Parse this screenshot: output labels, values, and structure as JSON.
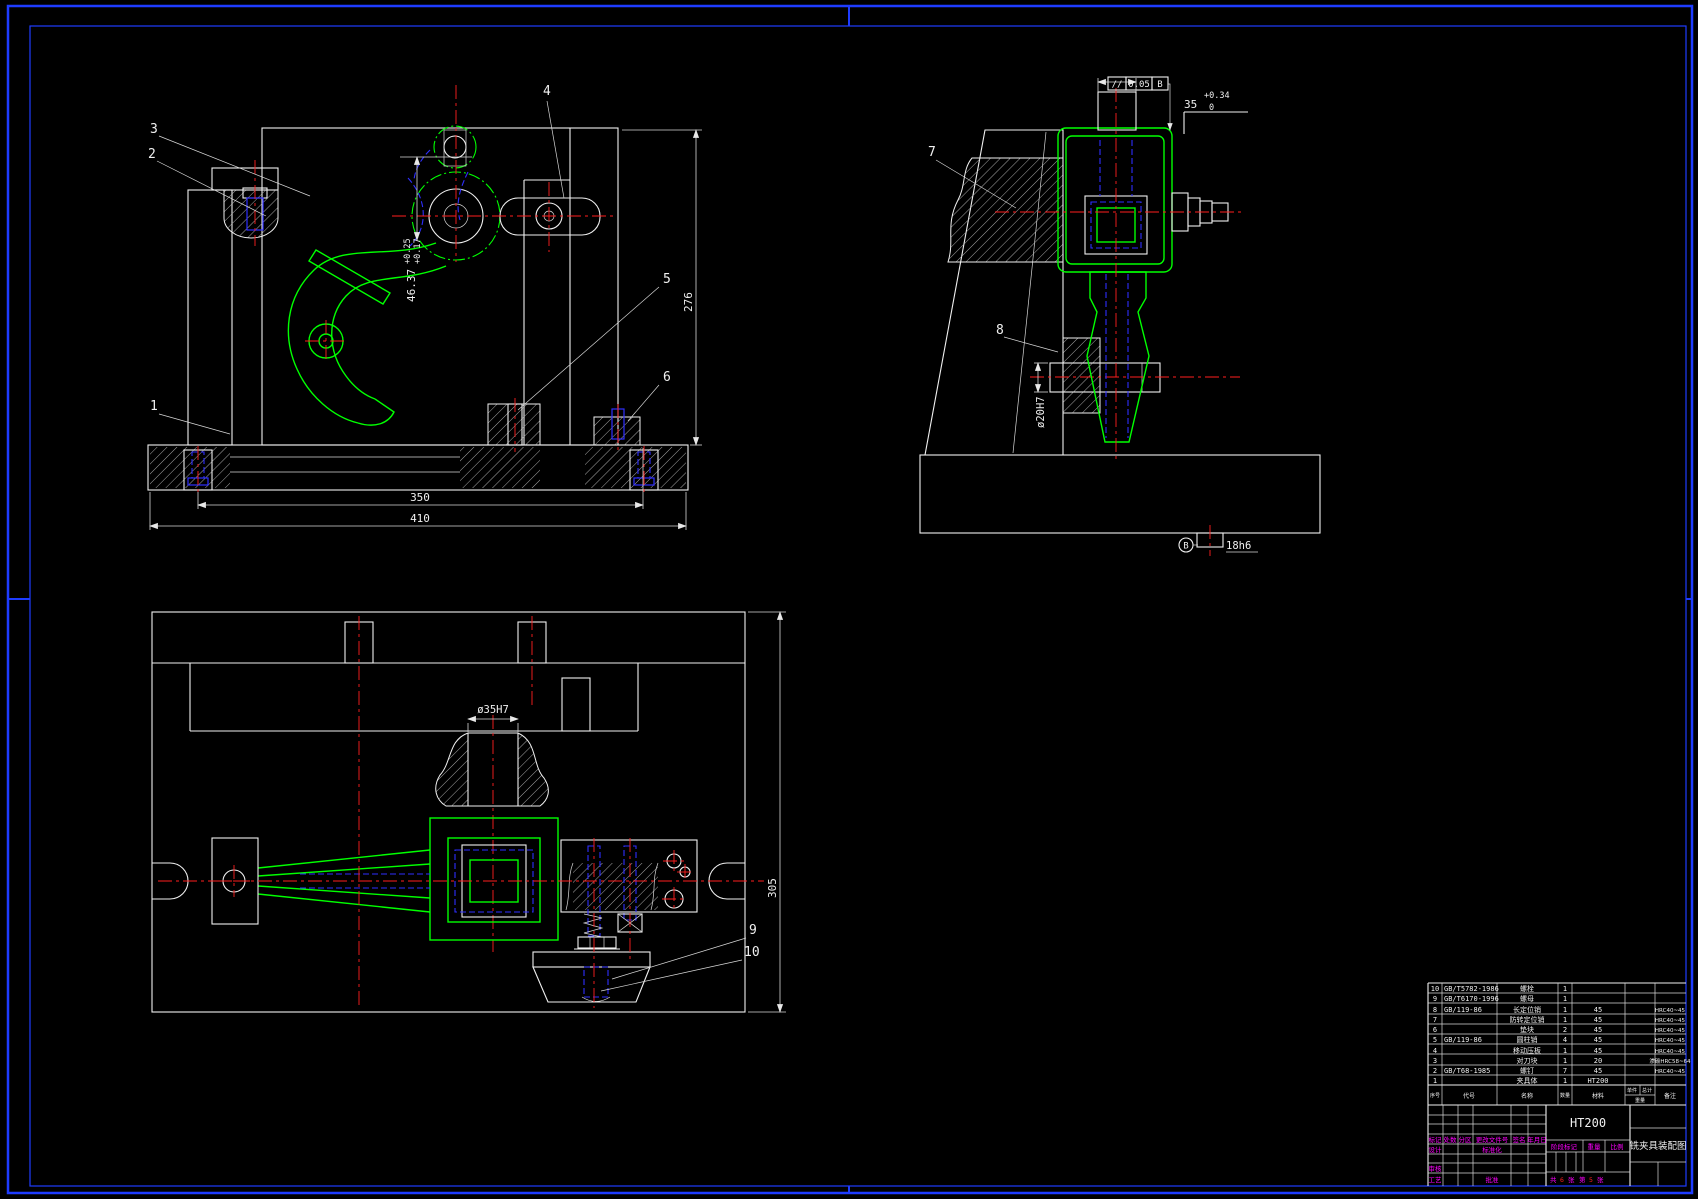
{
  "colors": {
    "frame_blue": "#1E3CFF",
    "line_white": "#F0F0F0",
    "part_green": "#00FF00",
    "center_red": "#FF1E1E",
    "hidden_blue": "#2E2EFF",
    "label_magenta": "#FF00FF"
  },
  "front_view": {
    "balloons": {
      "b1": "1",
      "b2": "2",
      "b3": "3",
      "b4": "4",
      "b5": "5",
      "b6": "6"
    },
    "dims": {
      "bore": "46.37",
      "bore_up": "+0.25",
      "bore_lo": "+0.17",
      "height": "276",
      "width_inner": "350",
      "width_outer": "410"
    }
  },
  "side_view": {
    "balloons": {
      "b7": "7",
      "b8": "8"
    },
    "dims": {
      "slot": "35",
      "slot_up": "+0.34",
      "slot_lo": "0",
      "pin": "ø20H7",
      "key": "18h6",
      "datum": "B"
    },
    "gdt": {
      "sym": "//",
      "val": "0.05",
      "ref": "B"
    }
  },
  "plan_view": {
    "balloons": {
      "b9": "9",
      "b10": "10"
    },
    "dims": {
      "hole": "ø35H7",
      "depth": "305"
    }
  },
  "parts_list": {
    "headers": {
      "no": "序号",
      "code": "代号",
      "name": "名称",
      "qty": "数量",
      "material": "材料",
      "wt_unit": "单件",
      "wt_total": "总计",
      "weight": "重量",
      "remark": "备注"
    },
    "rows": [
      {
        "no": "10",
        "code": "GB/T5782-1986",
        "name": "螺栓",
        "qty": "1",
        "material": "",
        "remark": ""
      },
      {
        "no": "9",
        "code": "GB/T6170-1996",
        "name": "螺母",
        "qty": "1",
        "material": "",
        "remark": ""
      },
      {
        "no": "8",
        "code": "GB/119-86",
        "name": "长定位销",
        "qty": "1",
        "material": "45",
        "remark": "HRC40~45"
      },
      {
        "no": "7",
        "code": "",
        "name": "防转定位销",
        "qty": "1",
        "material": "45",
        "remark": "HRC40~45"
      },
      {
        "no": "6",
        "code": "",
        "name": "垫块",
        "qty": "2",
        "material": "45",
        "remark": "HRC40~45"
      },
      {
        "no": "5",
        "code": "GB/119-86",
        "name": "圆柱销",
        "qty": "4",
        "material": "45",
        "remark": "HRC40~45"
      },
      {
        "no": "4",
        "code": "",
        "name": "移动压板",
        "qty": "1",
        "material": "45",
        "remark": "HRC40~45"
      },
      {
        "no": "3",
        "code": "",
        "name": "对刀块",
        "qty": "1",
        "material": "20",
        "remark": "渗碳HRC58~64"
      },
      {
        "no": "2",
        "code": "GB/T68-1985",
        "name": "螺钉",
        "qty": "7",
        "material": "45",
        "remark": "HRC40~45"
      },
      {
        "no": "1",
        "code": "",
        "name": "夹具体",
        "qty": "1",
        "material": "HT200",
        "remark": ""
      }
    ]
  },
  "title_block": {
    "material": "HT200",
    "drawing_title": "铣夹具装配图",
    "labels": {
      "mark": "标记",
      "count": "处数",
      "zone": "分区",
      "change_no": "更改文件号",
      "sign": "签名",
      "date": "年月日",
      "design": "设计",
      "standard": "标准化",
      "audit": "审核",
      "process": "工艺",
      "approve": "批准",
      "stage": "阶段标记",
      "weight": "重量",
      "scale": "比例"
    },
    "sheet": {
      "l1": "共",
      "total": "6",
      "l2": "张",
      "l3": "第",
      "page": "5",
      "l4": "张"
    }
  }
}
